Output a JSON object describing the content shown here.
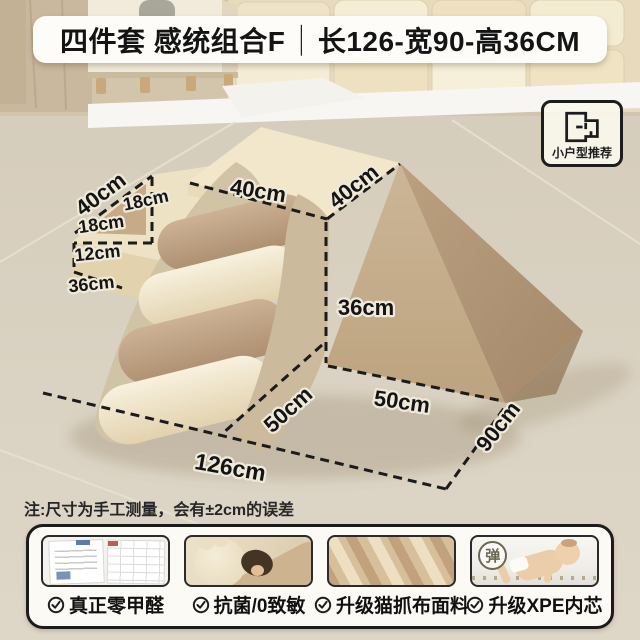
{
  "banner": {
    "title_left": "四件套 感统组合F",
    "separator": "｜",
    "title_right": "长126-宽90-高36CM"
  },
  "badge": {
    "label": "小户型推荐",
    "icon": "floor-plan-icon"
  },
  "dimensions": {
    "back_top": "40cm",
    "step_right": "18cm",
    "step_mid": "18cm",
    "step_low": "12cm",
    "step_base": "36cm",
    "platform_front": "40cm",
    "platform_right": "40cm",
    "wedge_height": "36cm",
    "base_left": "50cm",
    "base_right": "50cm",
    "base_depth": "90cm",
    "base_length": "126cm"
  },
  "note": "注:尺寸为手工测量，会有±2cm的误差",
  "features": [
    {
      "label": "真正零甲醛",
      "icon": "check-circle-icon",
      "thumb": "certificate-report"
    },
    {
      "label": "抗菌/0致敏",
      "icon": "check-circle-icon",
      "thumb": "child-on-soft-play"
    },
    {
      "label": "升级猫抓布面料",
      "icon": "check-circle-icon",
      "thumb": "cat-scratch-fabric-texture"
    },
    {
      "label": "升级XPE内芯",
      "icon": "check-circle-icon",
      "thumb": "baby-crawling-on-mat",
      "stamp": "弹"
    }
  ],
  "colors": {
    "floor": "#d8d0c0",
    "banner_bg": "#fdfcf9",
    "text_dark": "#141414",
    "dash_line": "#1b1b1b",
    "platform_cream": "#f2e6cb",
    "roller_tan": "#c2a385",
    "roller_cream": "#f3ead3",
    "panel_khaki": "#cfc1a4",
    "wedge_light": "#c7b192",
    "wedge_dark": "#b2977a",
    "panel_bg": "#fcfaf4",
    "border_black": "#1c1c1c"
  }
}
